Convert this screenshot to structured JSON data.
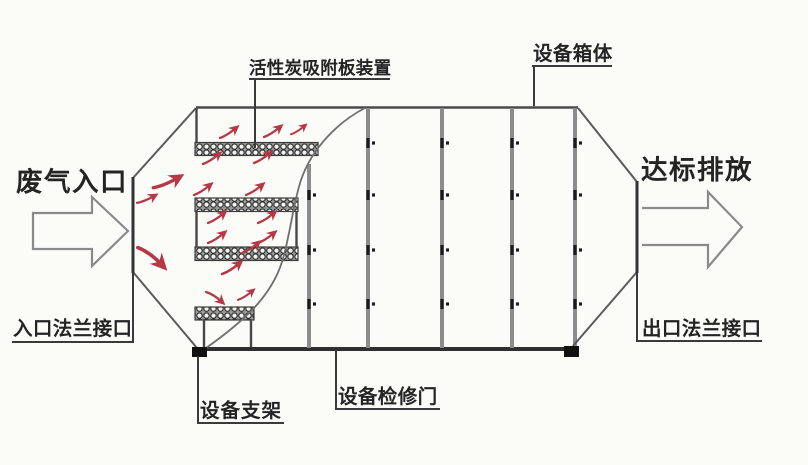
{
  "diagram": {
    "labels": {
      "adsorption_plate": "活性炭吸附板装置",
      "equipment_box": "设备箱体",
      "waste_gas_inlet": "废气入口",
      "compliant_discharge": "达标排放",
      "inlet_flange": "入口法兰接口",
      "outlet_flange": "出口法兰接口",
      "equipment_support": "设备支架",
      "access_door": "设备检修门"
    },
    "icons": {
      "inlet_arrow": "block-arrow-right-outline",
      "outlet_arrow": "block-arrow-right-outline",
      "airflow_arrow": "red-curved-flow-stroke",
      "carbon_plate": "mesh-hatched-bar",
      "bolt_mark": "black-dash-with-dot",
      "support_foot": "black-square"
    },
    "colors": {
      "background": "#fbfbf8",
      "outline": "#4a4a4a",
      "panel_divider": "#8c8c8c",
      "airflow_red": "#b63745",
      "label_text": "#242424",
      "block_arrow_outline": "#8a8a8a"
    }
  }
}
